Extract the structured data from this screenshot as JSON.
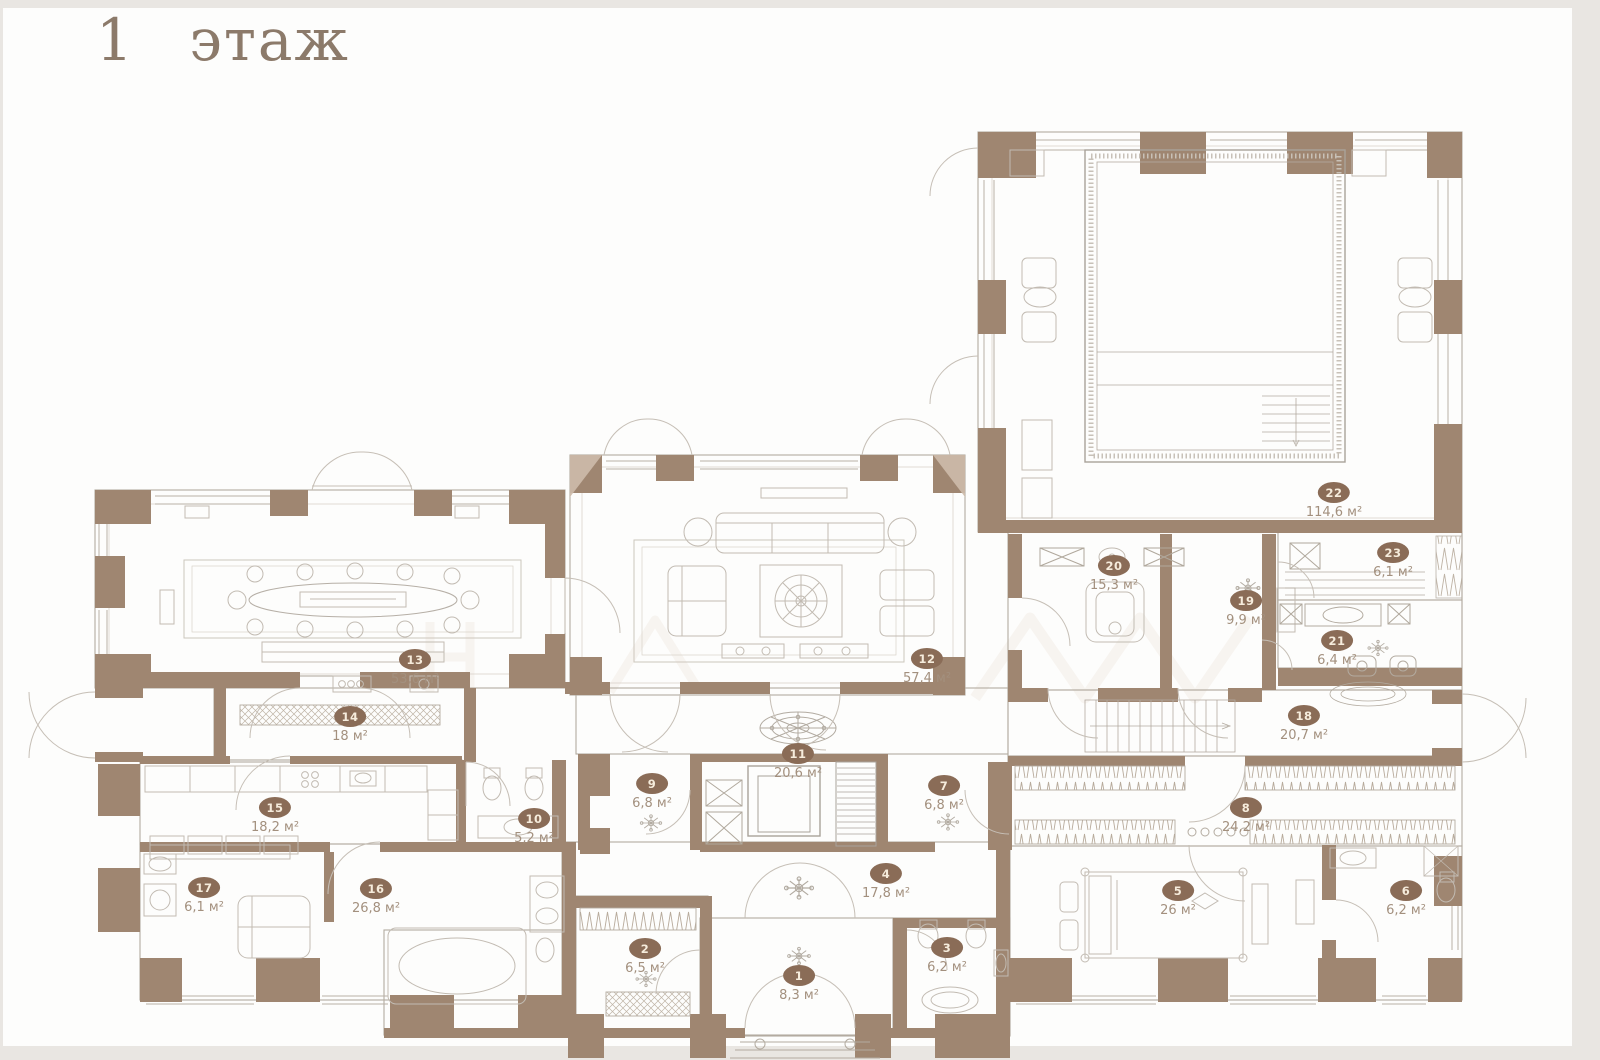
{
  "title": "1 этаж",
  "area_unit": "м²",
  "colors": {
    "wall_brown": "#9f8671",
    "wall_light": "#c9b6a4",
    "badge_fill": "#8a6c57",
    "badge_text": "#f6ecdc",
    "area_text": "#a3907e",
    "title_text": "#8c7a6a"
  },
  "rooms": [
    {
      "number": "1",
      "area": "8,3 м²",
      "x": 799,
      "y": 976
    },
    {
      "number": "2",
      "area": "6,5 м²",
      "x": 645,
      "y": 949
    },
    {
      "number": "3",
      "area": "6,2 м²",
      "x": 947,
      "y": 948
    },
    {
      "number": "4",
      "area": "17,8 м²",
      "x": 886,
      "y": 874
    },
    {
      "number": "5",
      "area": "26 м²",
      "x": 1178,
      "y": 891
    },
    {
      "number": "6",
      "area": "6,2 м²",
      "x": 1406,
      "y": 891
    },
    {
      "number": "7",
      "area": "6,8 м²",
      "x": 944,
      "y": 786
    },
    {
      "number": "8",
      "area": "24,2 м²",
      "x": 1246,
      "y": 808
    },
    {
      "number": "9",
      "area": "6,8 м²",
      "x": 652,
      "y": 784
    },
    {
      "number": "10",
      "area": "5,2 м²",
      "x": 534,
      "y": 819
    },
    {
      "number": "11",
      "area": "20,6 м²",
      "x": 798,
      "y": 754
    },
    {
      "number": "12",
      "area": "57,4 м²",
      "x": 927,
      "y": 659
    },
    {
      "number": "13",
      "area": "53,6 м²",
      "x": 415,
      "y": 660
    },
    {
      "number": "14",
      "area": "18 м²",
      "x": 350,
      "y": 717
    },
    {
      "number": "15",
      "area": "18,2 м²",
      "x": 275,
      "y": 808
    },
    {
      "number": "16",
      "area": "26,8 м²",
      "x": 376,
      "y": 889
    },
    {
      "number": "17",
      "area": "6,1 м²",
      "x": 204,
      "y": 888
    },
    {
      "number": "18",
      "area": "20,7 м²",
      "x": 1304,
      "y": 716
    },
    {
      "number": "19",
      "area": "9,9 м²",
      "x": 1246,
      "y": 601
    },
    {
      "number": "20",
      "area": "15,3 м²",
      "x": 1114,
      "y": 566
    },
    {
      "number": "21",
      "area": "6,4 м²",
      "x": 1337,
      "y": 641
    },
    {
      "number": "22",
      "area": "114,6 м²",
      "x": 1334,
      "y": 493
    },
    {
      "number": "23",
      "area": "6,1 м²",
      "x": 1393,
      "y": 553
    }
  ]
}
